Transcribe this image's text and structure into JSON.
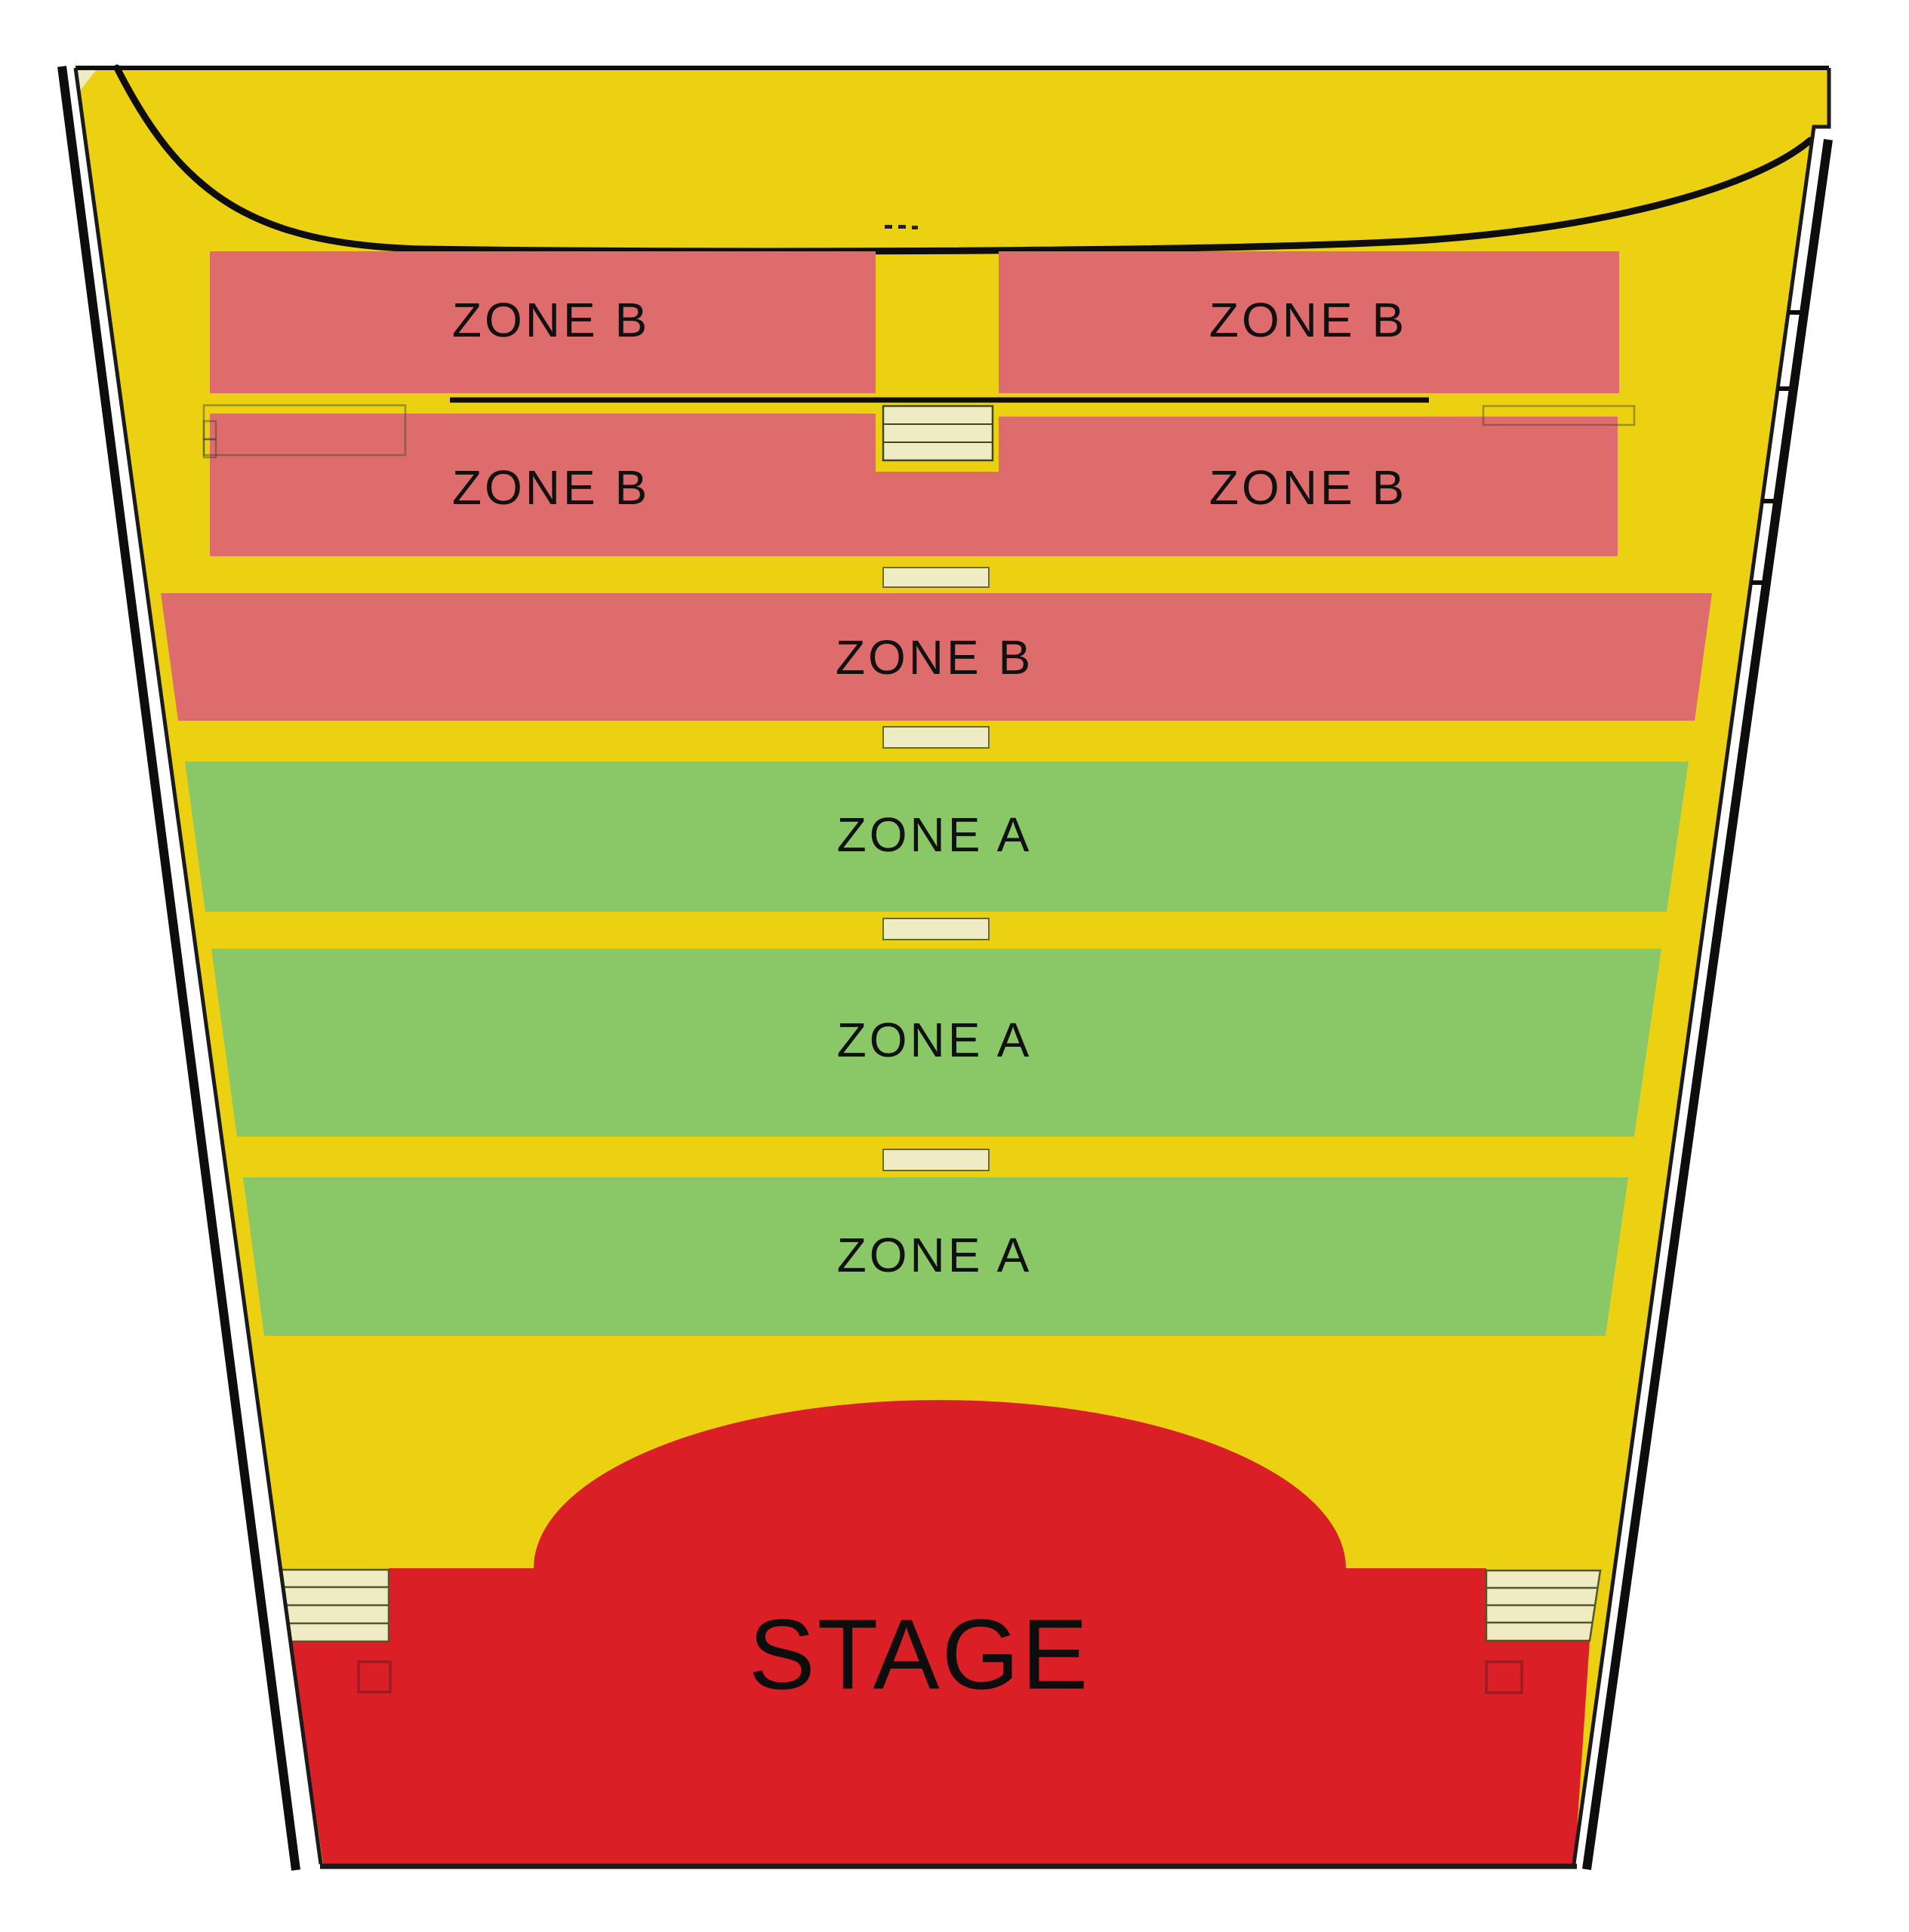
{
  "seating_map": {
    "rows": [
      {
        "id": "balcony-row1-left",
        "zone": "B",
        "label": "ZONE B"
      },
      {
        "id": "balcony-row1-right",
        "zone": "B",
        "label": "ZONE B"
      },
      {
        "id": "balcony-row2-left",
        "zone": "B",
        "label": "ZONE B"
      },
      {
        "id": "balcony-row2-right",
        "zone": "B",
        "label": "ZONE B"
      },
      {
        "id": "floor-row3",
        "zone": "B",
        "label": "ZONE B"
      },
      {
        "id": "floor-row4",
        "zone": "A",
        "label": "ZONE A"
      },
      {
        "id": "floor-row5",
        "zone": "A",
        "label": "ZONE A"
      },
      {
        "id": "floor-row6",
        "zone": "A",
        "label": "ZONE A"
      }
    ],
    "stage": {
      "label": "STAGE"
    },
    "colors": {
      "floor_yellow": "#ECD112",
      "zone_b_pink": "#DF6C6C",
      "zone_a_green": "#8AC867",
      "stage_red": "#DB1F26",
      "steps_cream": "#EFECC3",
      "outline_black": "#111111"
    }
  }
}
